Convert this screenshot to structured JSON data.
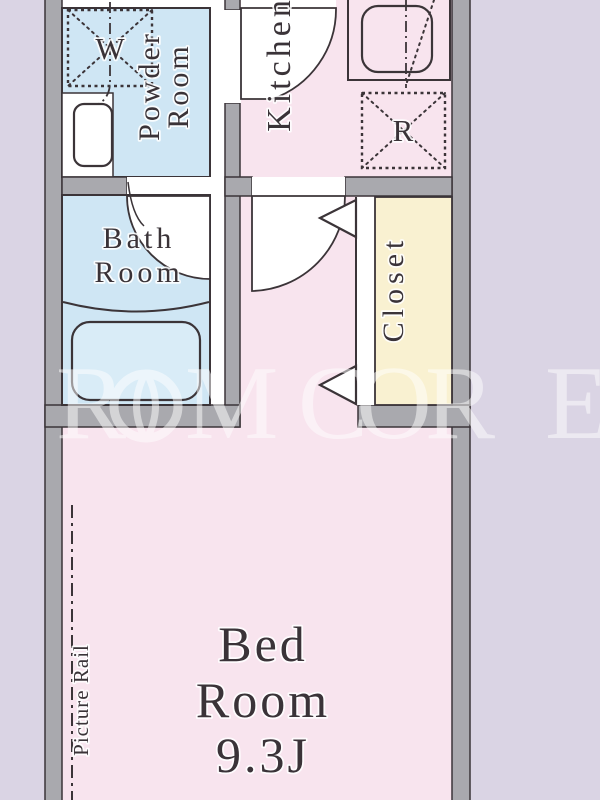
{
  "floorplan": {
    "watermark": {
      "text": "ROOM CORE",
      "letters": [
        "R",
        "M",
        "C",
        "O",
        "R",
        "E"
      ]
    },
    "rooms": {
      "powder_room": {
        "name": "Powder Room",
        "line1": "Powder",
        "line2": "Room"
      },
      "kitchen": {
        "name": "Kitchen",
        "label": "Kitchen"
      },
      "bath_room": {
        "name": "Bath Room",
        "line1": "Bath",
        "line2": "Room"
      },
      "closet": {
        "name": "Closet",
        "label": "Closet"
      },
      "bed_room": {
        "name": "Bed Room 9.3J",
        "line1": "Bed",
        "line2": "Room",
        "line3": "9.3J"
      }
    },
    "fixtures": {
      "washing_machine_label": "W",
      "refrigerator_label": "R"
    },
    "features": {
      "picture_rail_label": "Picture Rail"
    },
    "colors": {
      "background": "#dad4e4",
      "wall_fill": "#a9a9ae",
      "line": "#3b3438",
      "wet_room_fill": "#cfe6f4",
      "room_fill": "#f8e4ee",
      "closet_fill": "#f9f1d1",
      "bathtub_fill": "#d9ecf7",
      "watermark": "#ffffff"
    }
  }
}
